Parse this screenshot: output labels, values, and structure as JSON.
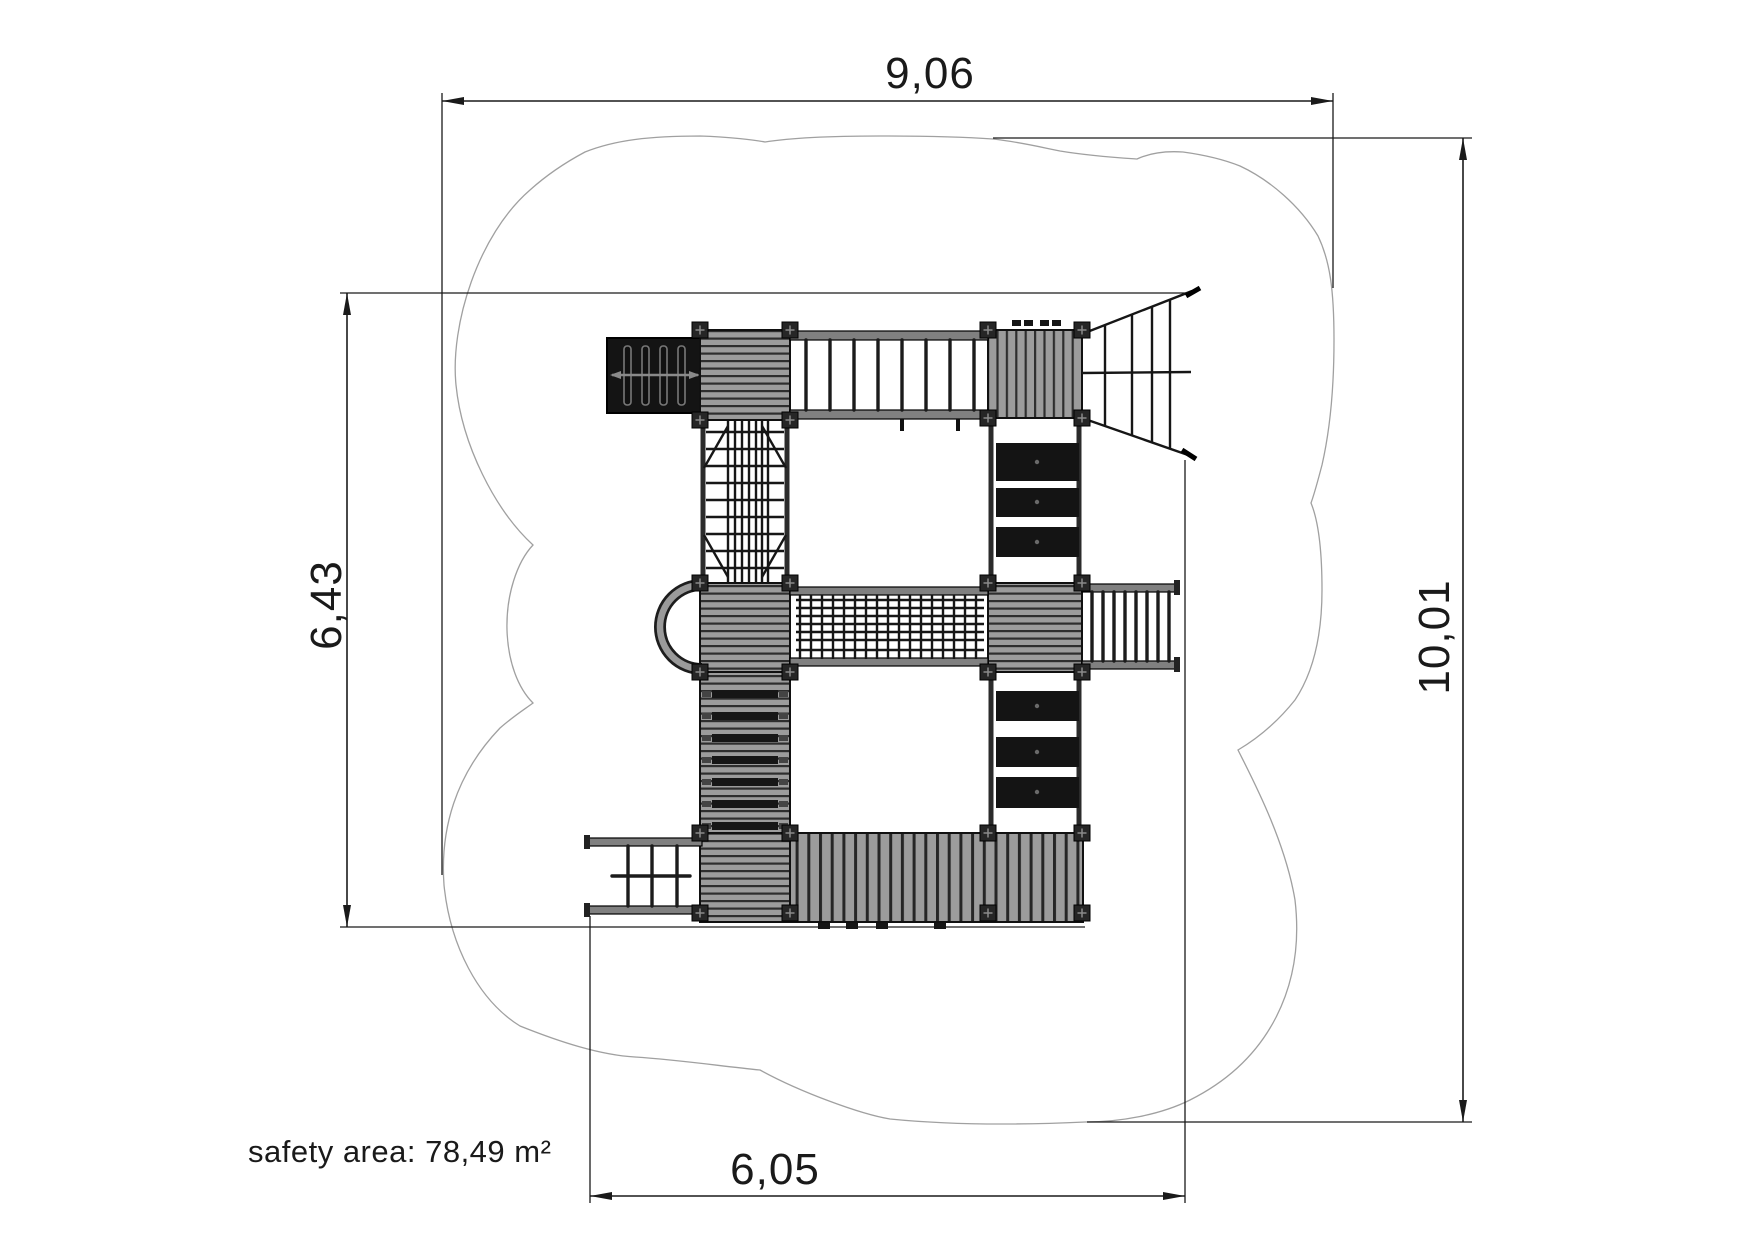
{
  "dimensions": {
    "top": "9,06",
    "right": "10,01",
    "left": "6,43",
    "bottom": "6,05"
  },
  "safety_area": "safety area: 78,49 m²",
  "colors": {
    "background": "#ffffff",
    "line": "#1a1a1a",
    "cloud_outline": "#a0a0a0",
    "deck_gray": "#9c9c9c",
    "dark_fill": "#161616",
    "rail_gray": "#808080"
  }
}
